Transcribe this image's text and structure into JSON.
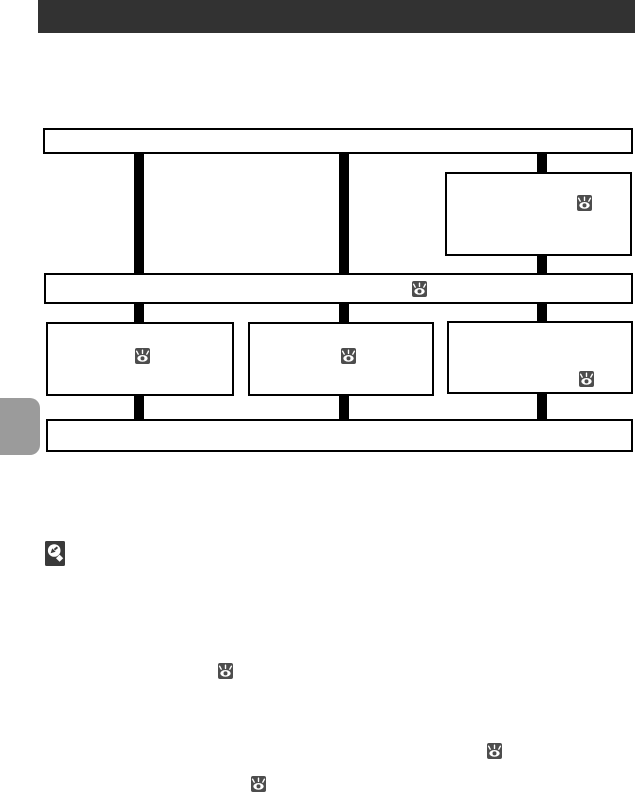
{
  "page": {
    "width": 635,
    "height": 799,
    "background": "#ffffff"
  },
  "colors": {
    "header_bar": "#323232",
    "box_border": "#000000",
    "connector": "#000000",
    "icon_bg": "#4d4d4d",
    "icon_glyph": "#ffffff",
    "magnifier_bg": "#3a3a3a",
    "chapter_tab": "#9b9b9b"
  },
  "header": {
    "type": "chapter-title-bar"
  },
  "flowchart": {
    "boxes": [
      {
        "id": "top-full-width",
        "icon": null
      },
      {
        "id": "right-detail",
        "icon": "eye-icon"
      },
      {
        "id": "middle-full-width",
        "icon": "eye-icon"
      },
      {
        "id": "bottom-row-left",
        "icon": "eye-icon"
      },
      {
        "id": "bottom-row-center",
        "icon": "eye-icon"
      },
      {
        "id": "bottom-row-right",
        "icon": "eye-icon"
      },
      {
        "id": "footer-full-width",
        "icon": null
      }
    ],
    "connector_count": 9
  },
  "icons": {
    "eye": {
      "name": "eye-icon",
      "color": "#4d4d4d"
    },
    "magnifier": {
      "name": "magnifier-note-icon",
      "color": "#3a3a3a"
    }
  },
  "inline_icons": [
    {
      "name": "eye-icon"
    },
    {
      "name": "eye-icon"
    },
    {
      "name": "eye-icon"
    }
  ]
}
